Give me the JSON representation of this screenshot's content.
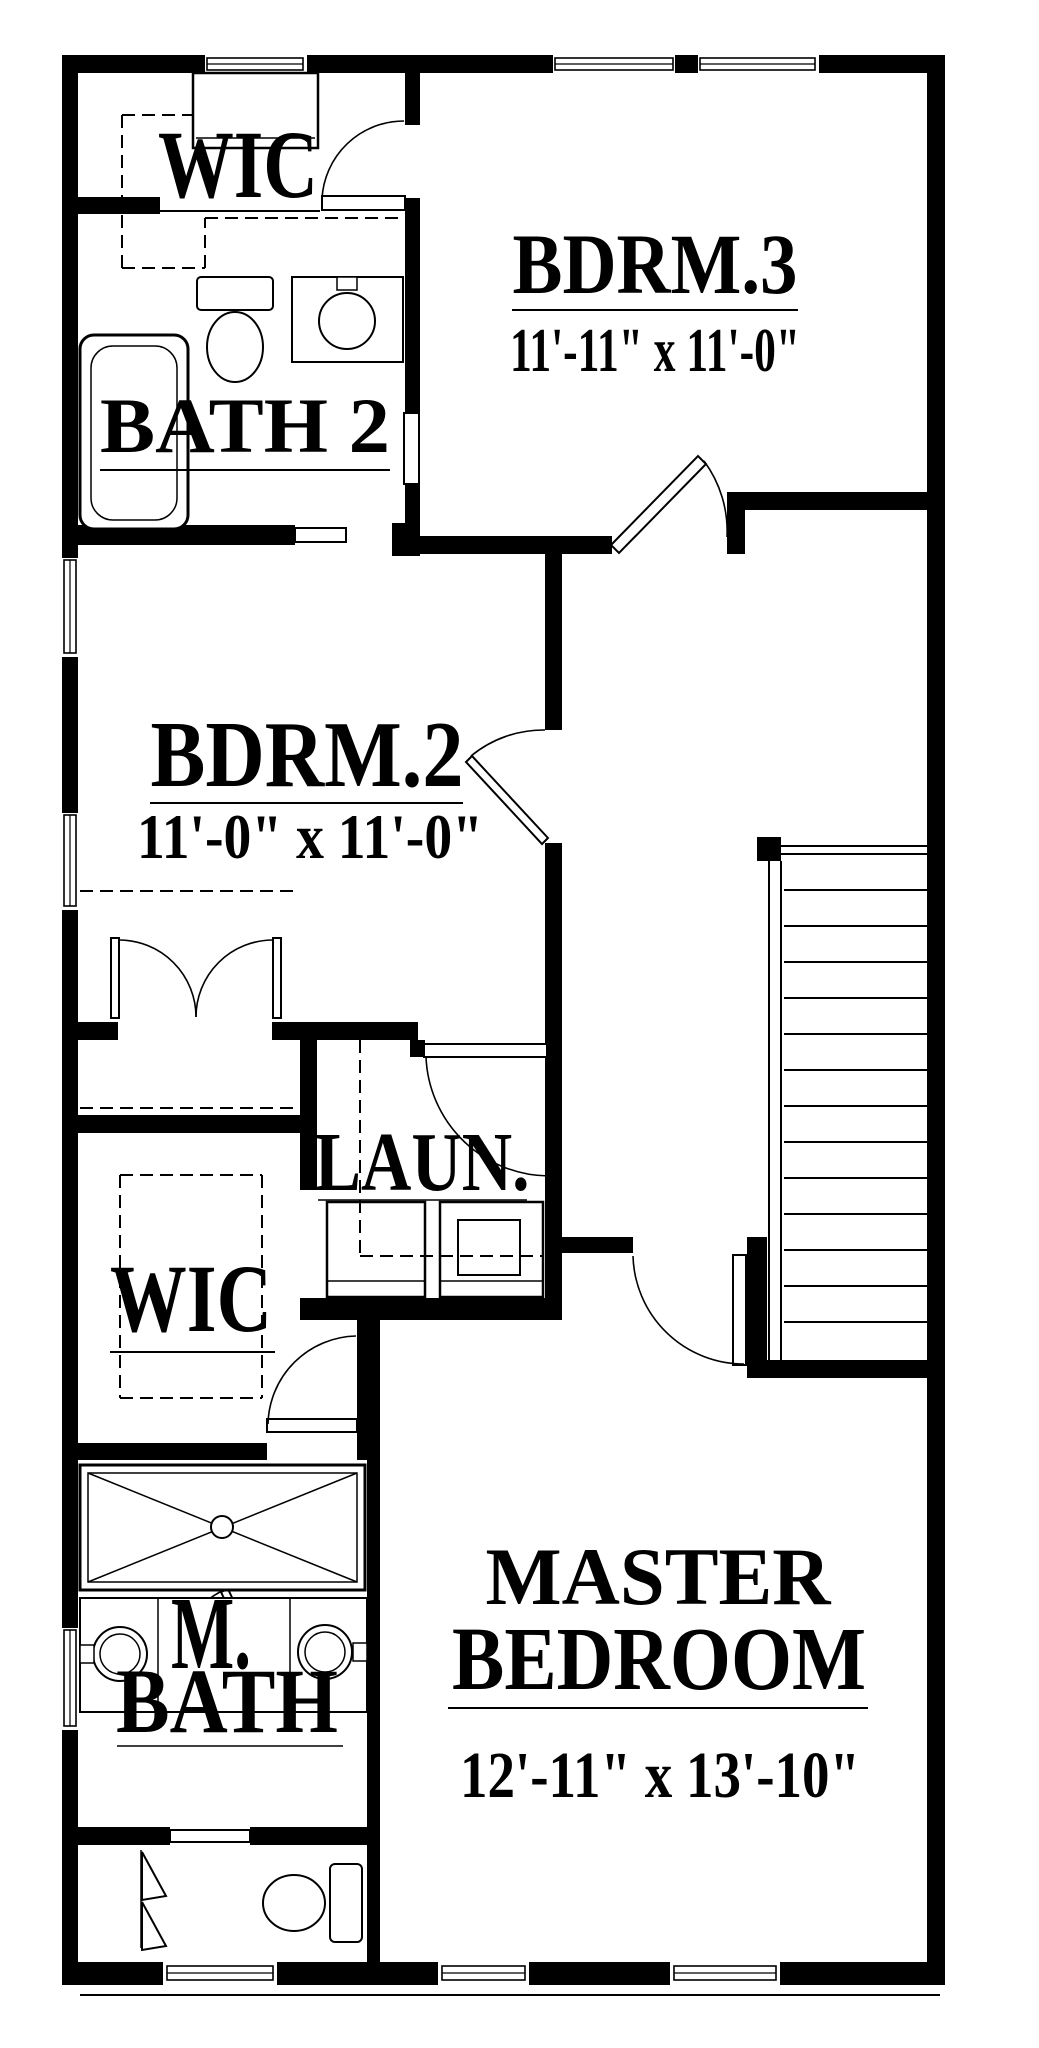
{
  "plan_title": "Second Floor Plan",
  "colors": {
    "wall": "#000000",
    "background": "#ffffff",
    "line": "#000000"
  },
  "rooms": {
    "wic_top": {
      "label": "WIC"
    },
    "bdrm3": {
      "label": "BDRM.3",
      "dims": "11'-11\" x 11'-0\""
    },
    "bath2": {
      "label": "BATH 2"
    },
    "bdrm2": {
      "label": "BDRM.2",
      "dims": "11'-0\" x 11'-0\""
    },
    "laundry": {
      "label": "LAUN."
    },
    "wic_lower": {
      "label": "WIC"
    },
    "mbath": {
      "label_line1": "M.",
      "label_line2": "BATH"
    },
    "master": {
      "label_line1": "MASTER",
      "label_line2": "BEDROOM",
      "dims": "12'-11\" x 13'-10\""
    }
  }
}
